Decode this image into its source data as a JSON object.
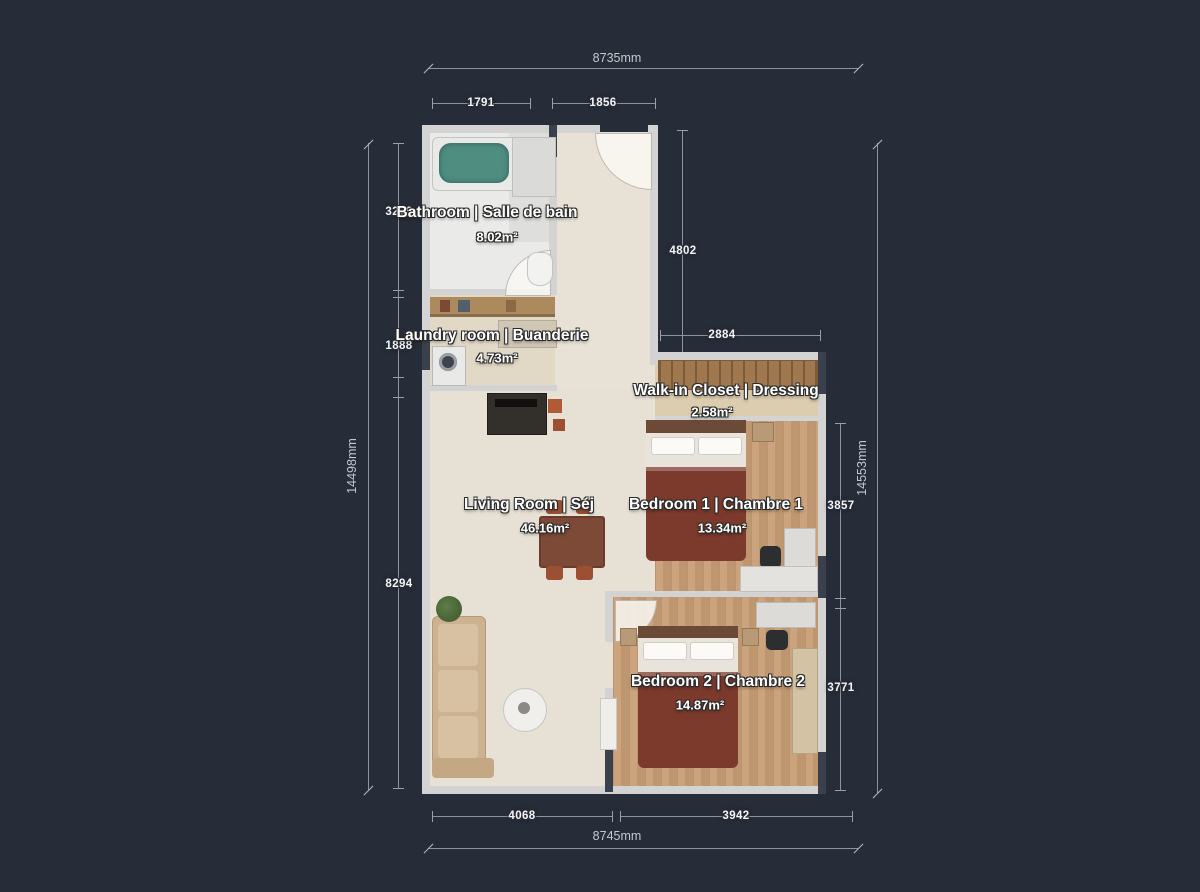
{
  "plan": {
    "type": "floor-plan",
    "background_color": "#272d38",
    "wall_color": "#d2d3d2",
    "dark_wall_color": "#3a414d",
    "floor_beige": "#e7e1d5",
    "floor_wood": "#c89f76",
    "dimension_line_color": "#8e939c",
    "label_text_color": "#ffffff"
  },
  "rooms": [
    {
      "name": "Bathroom  | Salle de bain",
      "area": "8.02m²"
    },
    {
      "name": "Laundry room | Buanderie",
      "area": "4.73m²"
    },
    {
      "name": "Walk-in Closet | Dressing",
      "area": "2.58m²"
    },
    {
      "name": "Living Room | Séj",
      "area": "46.16m²"
    },
    {
      "name": "Bedroom 1 | Chambre 1",
      "area": "13.34m²"
    },
    {
      "name": "Bedroom 2 | Chambre 2",
      "area": "14.87m²"
    }
  ],
  "dimensions": {
    "top": {
      "total": "8735mm",
      "seg": [
        "1791",
        "1856"
      ]
    },
    "bottom": {
      "total": "8745mm",
      "seg": [
        "4068",
        "3942"
      ]
    },
    "left": {
      "total": "14498mm",
      "seg": [
        "3266",
        "1888",
        "8294"
      ]
    },
    "right": {
      "total": "14553mm",
      "seg": [
        "3857",
        "3771"
      ]
    },
    "inner": {
      "vertical": "4802",
      "horizontal": "2884"
    }
  }
}
